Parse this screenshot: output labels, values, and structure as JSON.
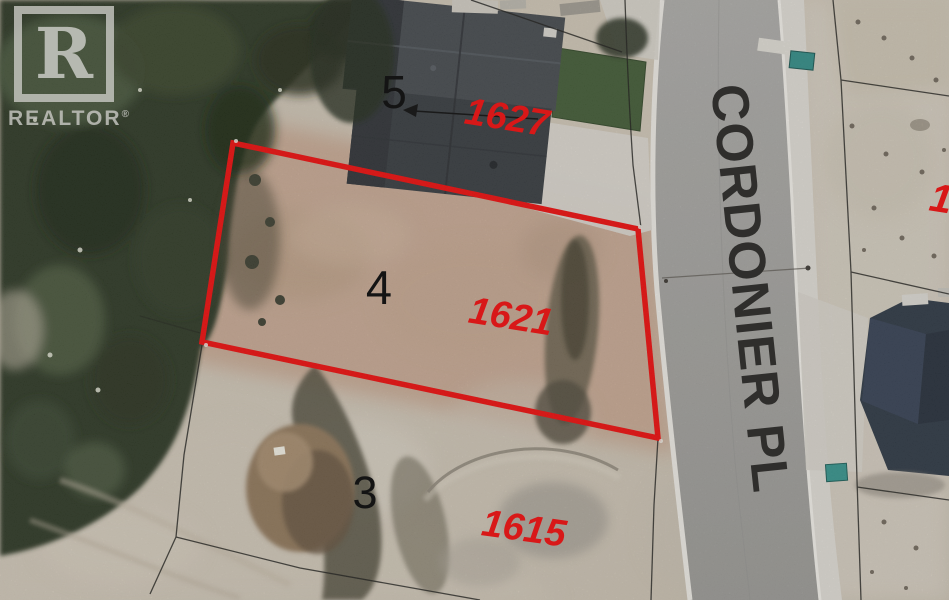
{
  "watermark": {
    "logo_letter": "R",
    "brand": "REALTOR",
    "registered": "®"
  },
  "street": {
    "name": "CORDONIER PL"
  },
  "lots": [
    {
      "number": "5",
      "address": "1627",
      "highlighted": false
    },
    {
      "number": "4",
      "address": "1621",
      "highlighted": true
    },
    {
      "number": "3",
      "address": "1615",
      "highlighted": false
    }
  ],
  "partial_address": "1",
  "colors": {
    "highlight_outline": "#ea0a0a",
    "address_text": "#d81818",
    "street_text": "#2f2e2c",
    "lot_number_text": "#141414"
  }
}
